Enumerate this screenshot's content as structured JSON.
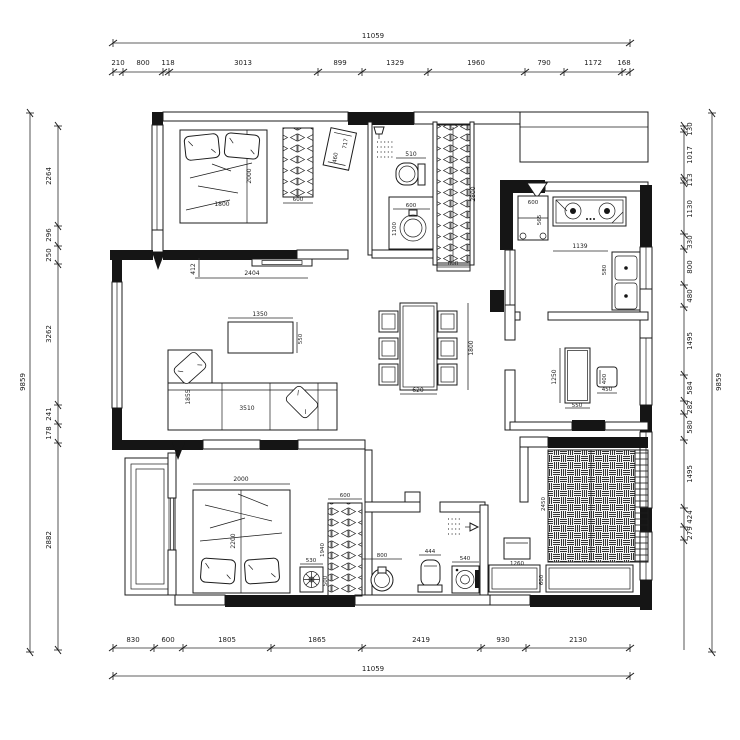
{
  "plan_title": "apartment-floor-plan",
  "dims": {
    "top": {
      "total": "11059",
      "segments": [
        "210",
        "800",
        "118",
        "3013",
        "899",
        "1329",
        "1960",
        "790",
        "1172",
        "168"
      ]
    },
    "bottom": {
      "total": "11059",
      "segments": [
        "830",
        "600",
        "1805",
        "1865",
        "2419",
        "930",
        "2130"
      ]
    },
    "left": {
      "total": "9859",
      "segments": [
        "2264",
        "296",
        "250",
        "3262",
        "241",
        "178",
        "2882"
      ]
    },
    "right": {
      "total": "9859",
      "segments": [
        "130",
        "1017",
        "113",
        "1130",
        "330",
        "800",
        "480",
        "1495",
        "584",
        "282",
        "580",
        "1495",
        "424",
        "279"
      ]
    }
  },
  "labels": {
    "bedroom1": {
      "bed_w": "1800",
      "bed_l": "2000",
      "wardrobe": "600",
      "bench_l": "717",
      "bench_w": "460",
      "wall_gap": "412",
      "wall_len": "2404"
    },
    "bath1": {
      "toilet": "510",
      "basin_w": "600",
      "basin_l": "1100"
    },
    "closet": {
      "len": "2800",
      "w": "600"
    },
    "kitchen": {
      "fridge_w": "600",
      "fridge_d": "565",
      "counter": "1139",
      "sink": "580"
    },
    "living": {
      "table_w": "1350",
      "table_d": "550",
      "sofa_w": "3510",
      "sofa_d": "1855"
    },
    "dining": {
      "table_w": "620",
      "table_l": "1800"
    },
    "study": {
      "desk_l": "1250",
      "desk_w": "550",
      "chair_w": "450",
      "chair_d": "400"
    },
    "bedroom2": {
      "bed_w": "2000",
      "bed_l": "2200",
      "stand_w": "530",
      "stand_d": "500",
      "wardrobe_w": "600",
      "wardrobe_l": "1940"
    },
    "bath2": {
      "basin": "800",
      "toilet": "444",
      "washer": "540",
      "cabinet": "1260"
    },
    "tatami": {
      "len": "2450",
      "counter_d": "600"
    }
  }
}
